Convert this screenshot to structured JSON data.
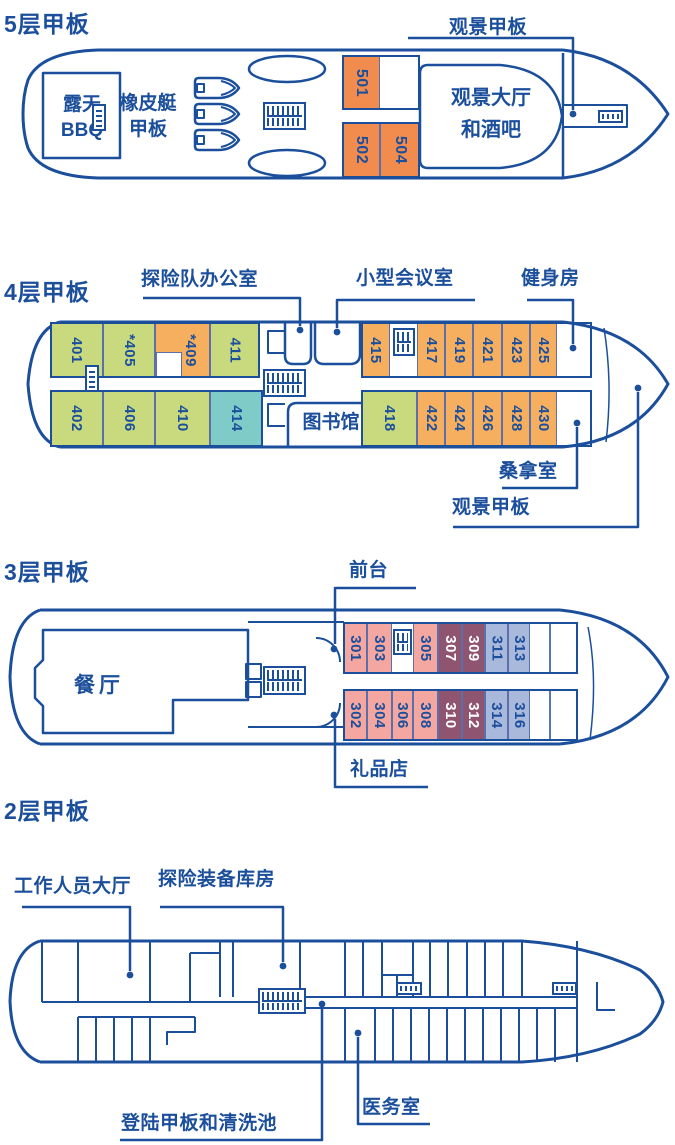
{
  "colors": {
    "line": "#1B4F9C",
    "cabin_orange": "#F28C4E",
    "cabin_gold": "#F5AF5F",
    "cabin_green": "#C8DA7D",
    "cabin_teal": "#7FCBC7",
    "cabin_pink": "#F3A7A0",
    "cabin_maroon": "#8E5470",
    "cabin_blue": "#A8B9DC",
    "cabin_border": "#5C6FA9"
  },
  "icons": {
    "stairs": "stairs-icon",
    "zodiac_boat": "zodiac-boat-icon",
    "tender_oval": "tender-boat-icon",
    "leader_dot": "leader-dot"
  },
  "decks": {
    "deck5": {
      "title": "5层甲板",
      "labels": {
        "observation_deck": "观景甲板"
      },
      "rooms": {
        "bbq_line1": "露天",
        "bbq_line2": "BBQ",
        "zodiac_line1": "橡皮艇",
        "zodiac_line2": "甲板",
        "lounge_line1": "观景大厅",
        "lounge_line2": "和酒吧"
      },
      "cabins": {
        "c501": "501",
        "c502": "502",
        "c504": "504"
      }
    },
    "deck4": {
      "title": "4层甲板",
      "labels": {
        "expedition_office": "探险队办公室",
        "meeting_room": "小型会议室",
        "gym": "健身房",
        "sauna": "桑拿室",
        "observation_deck": "观景甲板"
      },
      "rooms": {
        "library": "图书馆"
      },
      "cabins": {
        "c401": "401",
        "c405": "*405",
        "c409": "*409",
        "c411": "411",
        "c415": "415",
        "c417": "417",
        "c419": "419",
        "c421": "421",
        "c423": "423",
        "c425": "425",
        "c402": "402",
        "c406": "406",
        "c410": "410",
        "c414": "414",
        "c418": "418",
        "c422": "422",
        "c424": "424",
        "c426": "426",
        "c428": "428",
        "c430": "430"
      }
    },
    "deck3": {
      "title": "3层甲板",
      "labels": {
        "reception": "前台",
        "gift_shop": "礼品店"
      },
      "rooms": {
        "dining": "餐厅"
      },
      "cabins": {
        "c301": "301",
        "c303": "303",
        "c305": "305",
        "c307": "307",
        "c309": "309",
        "c311": "311",
        "c313": "313",
        "c302": "302",
        "c304": "304",
        "c306": "306",
        "c308": "308",
        "c310": "310",
        "c312": "312",
        "c314": "314",
        "c316": "316"
      }
    },
    "deck2": {
      "title": "2层甲板",
      "labels": {
        "staff_lounge": "工作人员大厅",
        "equipment_store": "探险装备库房",
        "landing_deck": "登陆甲板和清洗池",
        "medical": "医务室"
      }
    }
  }
}
